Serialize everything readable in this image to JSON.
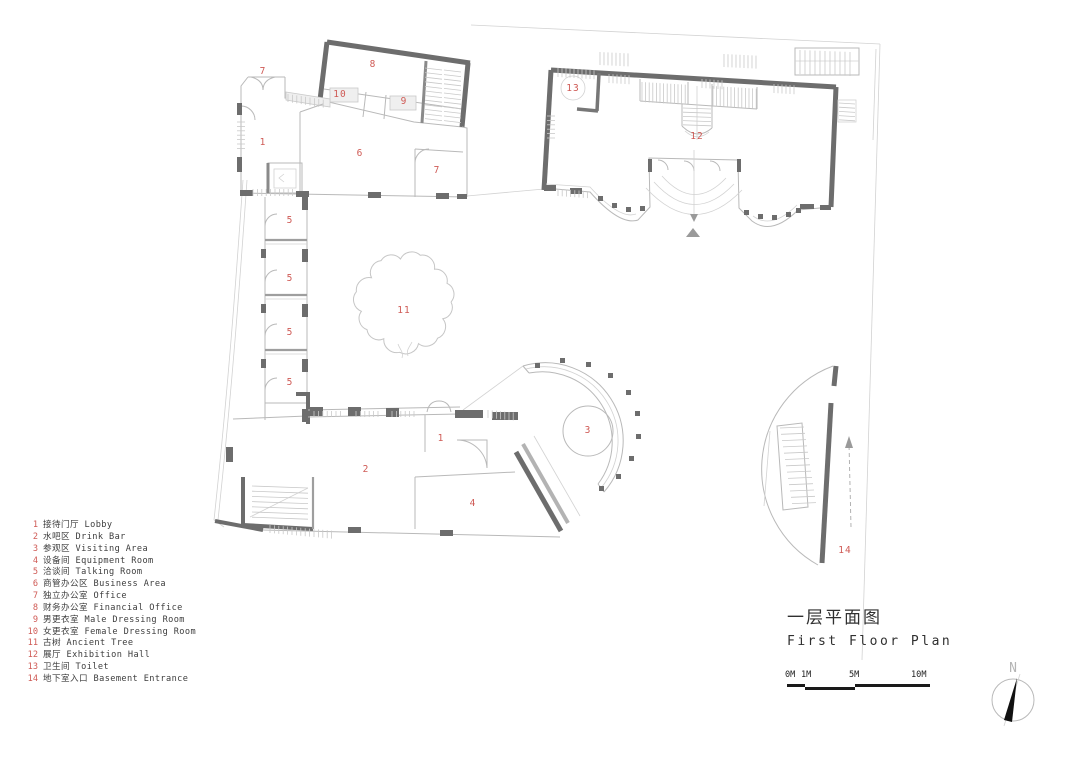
{
  "title": {
    "zh": "一层平面图",
    "en": "First Floor Plan"
  },
  "legend": {
    "items": [
      {
        "num": "1",
        "label": "接待门厅 Lobby"
      },
      {
        "num": "2",
        "label": "水吧区 Drink Bar"
      },
      {
        "num": "3",
        "label": "参观区 Visiting Area"
      },
      {
        "num": "4",
        "label": "设备间 Equipment Room"
      },
      {
        "num": "5",
        "label": "洽谈间 Talking Room"
      },
      {
        "num": "6",
        "label": "商管办公区 Business Area"
      },
      {
        "num": "7",
        "label": "独立办公室 Office"
      },
      {
        "num": "8",
        "label": "财务办公室 Financial Office"
      },
      {
        "num": "9",
        "label": "男更衣室 Male Dressing Room"
      },
      {
        "num": "10",
        "label": "女更衣室 Female Dressing Room"
      },
      {
        "num": "11",
        "label": "古树 Ancient Tree"
      },
      {
        "num": "12",
        "label": "展厅 Exhibition Hall"
      },
      {
        "num": "13",
        "label": "卫生间 Toilet"
      },
      {
        "num": "14",
        "label": "地下室入口 Basement Entrance"
      }
    ]
  },
  "scale_bar": {
    "labels": [
      "0M",
      "1M",
      "5M",
      "10M"
    ]
  },
  "north": {
    "label": "N"
  },
  "plan": {
    "room_labels": [
      {
        "n": "7",
        "x": 263,
        "y": 74
      },
      {
        "n": "8",
        "x": 373,
        "y": 67
      },
      {
        "n": "10",
        "x": 340,
        "y": 97
      },
      {
        "n": "9",
        "x": 404,
        "y": 104
      },
      {
        "n": "13",
        "x": 573,
        "y": 91
      },
      {
        "n": "12",
        "x": 697,
        "y": 139
      },
      {
        "n": "1",
        "x": 263,
        "y": 145
      },
      {
        "n": "6",
        "x": 360,
        "y": 156
      },
      {
        "n": "7",
        "x": 437,
        "y": 173
      },
      {
        "n": "5",
        "x": 290,
        "y": 223
      },
      {
        "n": "5",
        "x": 290,
        "y": 281
      },
      {
        "n": "5",
        "x": 290,
        "y": 335
      },
      {
        "n": "5",
        "x": 290,
        "y": 385
      },
      {
        "n": "11",
        "x": 404,
        "y": 313
      },
      {
        "n": "3",
        "x": 588,
        "y": 433
      },
      {
        "n": "1",
        "x": 441,
        "y": 441
      },
      {
        "n": "2",
        "x": 366,
        "y": 472
      },
      {
        "n": "4",
        "x": 473,
        "y": 506
      },
      {
        "n": "14",
        "x": 845,
        "y": 553
      }
    ]
  },
  "colors": {
    "accent_red": "#cf5a55",
    "wall_dark": "#6d6d6d",
    "line_light": "#c2c2c2"
  }
}
